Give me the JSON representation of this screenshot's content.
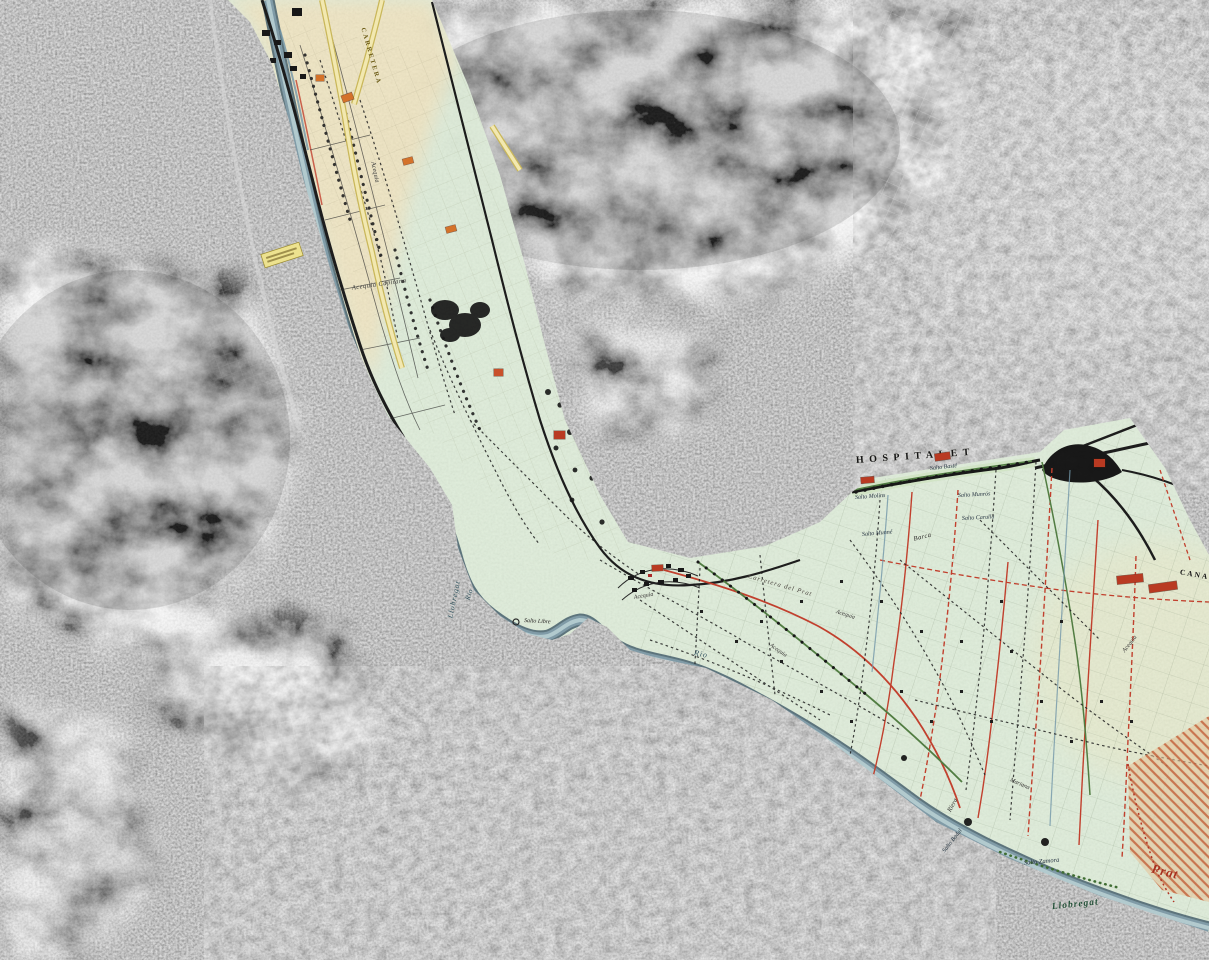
{
  "map": {
    "kind": "historic-irrigation-map-overlay-on-aerial-photo",
    "river_valley": "Llobregat",
    "city_shown": "HOSPITALET"
  },
  "colors": {
    "overlay_cream": "#f0e5c2",
    "overlay_green": "#dfeeda",
    "river_dark": "#4f6d7c",
    "river_mid": "#7d9aa6",
    "river_light": "#b7cfd4",
    "road_yellow": "#f2e8b0",
    "road_yellow_casing": "#c9b75a",
    "line_red": "#c23b28",
    "hatch_red": "#c0522a",
    "hatch_fill": "#e8c49a",
    "tree_green": "#4d7a3d",
    "ink_black": "#1a1a1a"
  },
  "labels": [
    {
      "id": "carretera-road",
      "text": "CARRETERA",
      "x": 362,
      "y": 28,
      "rot": 74,
      "size": 6.5,
      "color": "#6b5a14",
      "cls": "bold",
      "spacing": 2
    },
    {
      "id": "acequia-upper",
      "text": "Acequia",
      "x": 372,
      "y": 162,
      "rot": 78,
      "size": 6.5,
      "color": "#333333",
      "cls": "italic",
      "spacing": 0
    },
    {
      "id": "acequia-capitana",
      "text": "Acequia Capitana",
      "x": 352,
      "y": 289,
      "rot": -8,
      "size": 6.5,
      "color": "#333333",
      "cls": "italic",
      "spacing": 0.5
    },
    {
      "id": "llobregat-river-upper",
      "text": "Llobregat",
      "x": 450,
      "y": 618,
      "rot": -78,
      "size": 7.5,
      "color": "#30525f",
      "cls": "italic",
      "spacing": 1
    },
    {
      "id": "rio-upper",
      "text": "Rio",
      "x": 468,
      "y": 600,
      "rot": -72,
      "size": 7,
      "color": "#30525f",
      "cls": "italic",
      "spacing": 0.5
    },
    {
      "id": "rio-mid",
      "text": "Rio",
      "x": 694,
      "y": 653,
      "rot": 12,
      "size": 8,
      "color": "#30525f",
      "cls": "italic",
      "spacing": 1
    },
    {
      "id": "salto-libre",
      "text": "Salto Libre",
      "x": 524,
      "y": 621,
      "rot": 3,
      "size": 6,
      "color": "#222222",
      "cls": "italic",
      "spacing": 0
    },
    {
      "id": "hospitalet",
      "text": "HOSPITALET",
      "x": 856,
      "y": 461,
      "rot": -4,
      "size": 10,
      "color": "#151515",
      "cls": "bold",
      "spacing": 5.5
    },
    {
      "id": "canal-caps",
      "text": "CANAL",
      "x": 1180,
      "y": 572,
      "rot": 10,
      "size": 7.5,
      "color": "#151515",
      "cls": "bold",
      "spacing": 2
    },
    {
      "id": "salto-baste",
      "text": "Salto Basté",
      "x": 930,
      "y": 469,
      "rot": -6,
      "size": 6,
      "color": "#1a2a3a",
      "cls": "italic",
      "spacing": 0
    },
    {
      "id": "salto-molins",
      "text": "Salto Molins",
      "x": 855,
      "y": 498,
      "rot": -4,
      "size": 6,
      "color": "#1a2a3a",
      "cls": "italic",
      "spacing": 0
    },
    {
      "id": "salto-munne",
      "text": "Salto Munné",
      "x": 862,
      "y": 535,
      "rot": -5,
      "size": 6,
      "color": "#1a2a3a",
      "cls": "italic",
      "spacing": 0
    },
    {
      "id": "salto-munros",
      "text": "Salto Munrós",
      "x": 958,
      "y": 496,
      "rot": -3,
      "size": 6,
      "color": "#1a2a3a",
      "cls": "italic",
      "spacing": 0
    },
    {
      "id": "salto-carulla",
      "text": "Salto Carulla",
      "x": 962,
      "y": 519,
      "rot": -3,
      "size": 6,
      "color": "#1a2a3a",
      "cls": "italic",
      "spacing": 0
    },
    {
      "id": "salto-zamora",
      "text": "Salto Zamora",
      "x": 1024,
      "y": 864,
      "rot": -5,
      "size": 6.5,
      "color": "#1a2a3a",
      "cls": "italic",
      "spacing": 0
    },
    {
      "id": "salto-badal",
      "text": "Salto Badal",
      "x": 944,
      "y": 852,
      "rot": -52,
      "size": 6,
      "color": "#1a2a3a",
      "cls": "italic",
      "spacing": 0
    },
    {
      "id": "barca",
      "text": "Barca",
      "x": 914,
      "y": 540,
      "rot": -14,
      "size": 6.5,
      "color": "#222222",
      "cls": "italic",
      "spacing": 0.5
    },
    {
      "id": "carretera-prat",
      "text": "Carretera del Prat",
      "x": 748,
      "y": 577,
      "rot": 16,
      "size": 6.5,
      "color": "#44403a",
      "cls": "italic",
      "spacing": 1
    },
    {
      "id": "prat",
      "text": "Prat",
      "x": 1152,
      "y": 868,
      "rot": 14,
      "size": 13,
      "color": "#a8301e",
      "cls": "bold italic",
      "spacing": 1
    },
    {
      "id": "llobregat-lower",
      "text": "Llobregat",
      "x": 1052,
      "y": 908,
      "rot": -6,
      "size": 9.5,
      "color": "#24513a",
      "cls": "bold italic",
      "spacing": 1
    },
    {
      "id": "riera",
      "text": "Riera",
      "x": 950,
      "y": 812,
      "rot": -62,
      "size": 6.5,
      "color": "#2a2a2a",
      "cls": "italic",
      "spacing": 0
    },
    {
      "id": "mariana",
      "text": "Mariana",
      "x": 1010,
      "y": 780,
      "rot": 24,
      "size": 6,
      "color": "#2a2a2a",
      "cls": "italic",
      "spacing": 0
    },
    {
      "id": "acequia-a",
      "text": "Acequia",
      "x": 634,
      "y": 598,
      "rot": -10,
      "size": 6,
      "color": "#333333",
      "cls": "italic",
      "spacing": 0
    },
    {
      "id": "acequia-b",
      "text": "Acequia",
      "x": 1124,
      "y": 652,
      "rot": -52,
      "size": 6,
      "color": "#333333",
      "cls": "italic",
      "spacing": 0
    },
    {
      "id": "acequia-c",
      "text": "Acequia",
      "x": 836,
      "y": 612,
      "rot": 18,
      "size": 6,
      "color": "#333333",
      "cls": "italic",
      "spacing": 0
    },
    {
      "id": "acequia-d",
      "text": "Acequia",
      "x": 770,
      "y": 645,
      "rot": 35,
      "size": 6,
      "color": "#333333",
      "cls": "italic",
      "spacing": 0
    }
  ],
  "markers": [
    {
      "x": 342,
      "y": 94,
      "w": 11,
      "h": 7,
      "rot": -20,
      "color": "#d4722a"
    },
    {
      "x": 316,
      "y": 75,
      "w": 8,
      "h": 6,
      "rot": 0,
      "color": "#d4722a"
    },
    {
      "x": 403,
      "y": 158,
      "w": 10,
      "h": 6,
      "rot": -15,
      "color": "#d4722a"
    },
    {
      "x": 446,
      "y": 226,
      "w": 10,
      "h": 6,
      "rot": -15,
      "color": "#d4722a"
    },
    {
      "x": 494,
      "y": 369,
      "w": 9,
      "h": 7,
      "rot": 0,
      "color": "#c8502a"
    },
    {
      "x": 554,
      "y": 431,
      "w": 11,
      "h": 8,
      "rot": 0,
      "color": "#b93a22"
    },
    {
      "x": 935,
      "y": 453,
      "w": 15,
      "h": 7,
      "rot": -8,
      "color": "#b93a22"
    },
    {
      "x": 861,
      "y": 477,
      "w": 13,
      "h": 6,
      "rot": -5,
      "color": "#b93a22"
    },
    {
      "x": 1094,
      "y": 459,
      "w": 11,
      "h": 8,
      "rot": 0,
      "color": "#b93a22"
    },
    {
      "x": 1117,
      "y": 575,
      "w": 26,
      "h": 8,
      "rot": -6,
      "color": "#b93a22"
    },
    {
      "x": 1149,
      "y": 583,
      "w": 28,
      "h": 8,
      "rot": -8,
      "color": "#b93a22"
    },
    {
      "x": 652,
      "y": 565,
      "w": 11,
      "h": 6,
      "rot": -3,
      "color": "#b93a22"
    }
  ]
}
